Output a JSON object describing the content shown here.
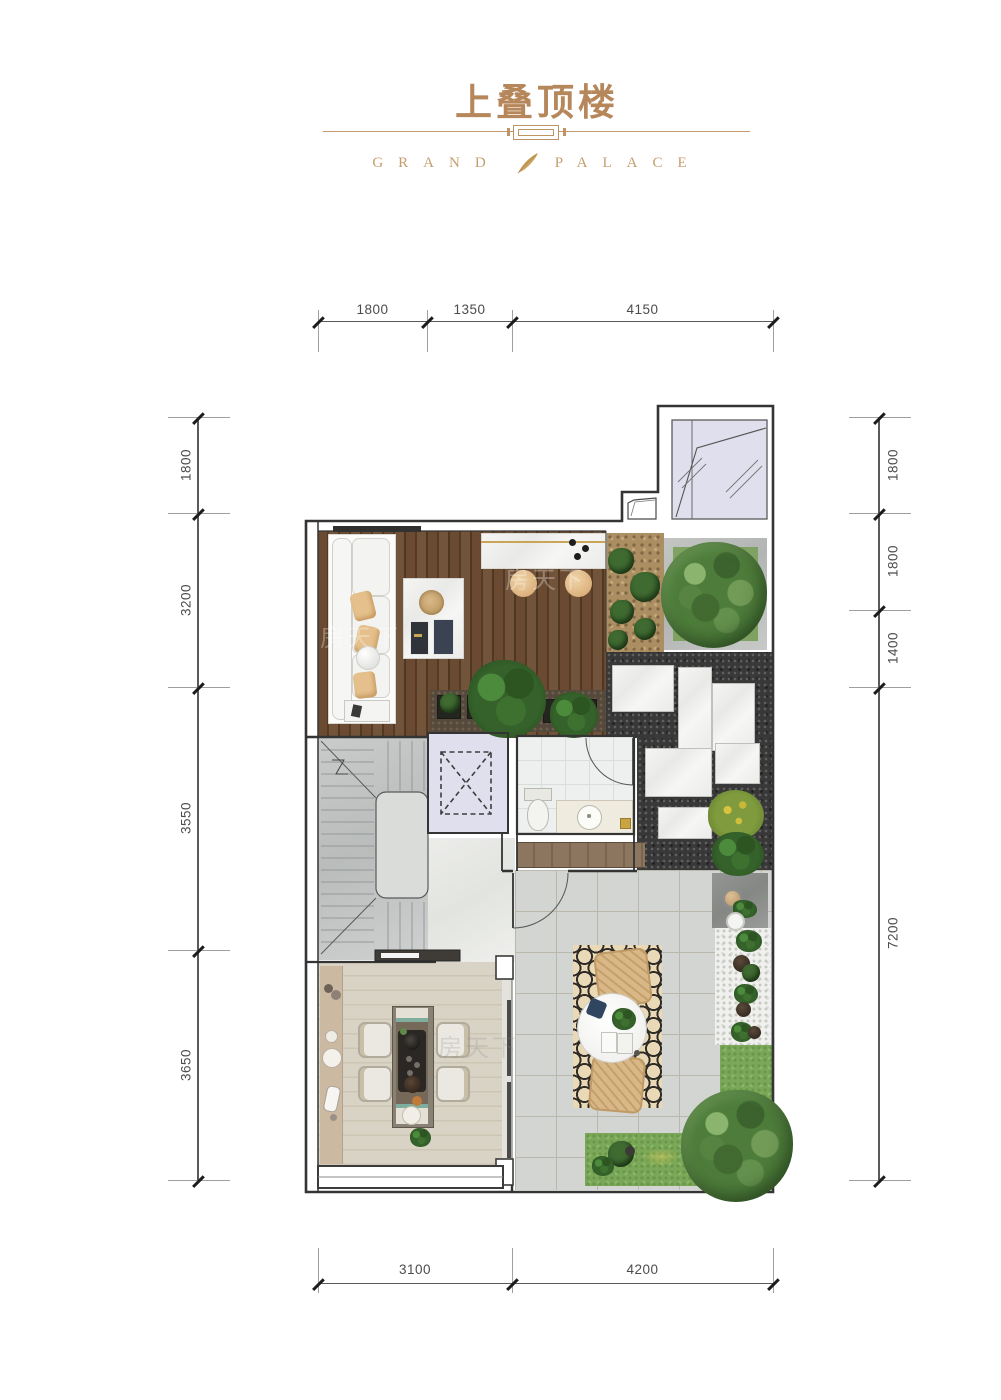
{
  "header": {
    "title": "上叠顶楼",
    "brand_left": "GRAND",
    "brand_right": "PALACE"
  },
  "dimensions": {
    "top": [
      "1800",
      "1350",
      "4150"
    ],
    "bottom": [
      "3100",
      "4200"
    ],
    "left": [
      "1800",
      "3200",
      "3550",
      "3650"
    ],
    "right": [
      "1800",
      "1800",
      "1400",
      "7200"
    ]
  },
  "watermark": {
    "text": "房天下"
  },
  "colors": {
    "accent_gold": "#b6875a",
    "brand_gold": "#c59e6e",
    "deck_wood": "#6a4b32",
    "terrace_tile": "#d2d5d1",
    "tree_green": "#4e7d3b",
    "skylight": "#dfdfed"
  }
}
